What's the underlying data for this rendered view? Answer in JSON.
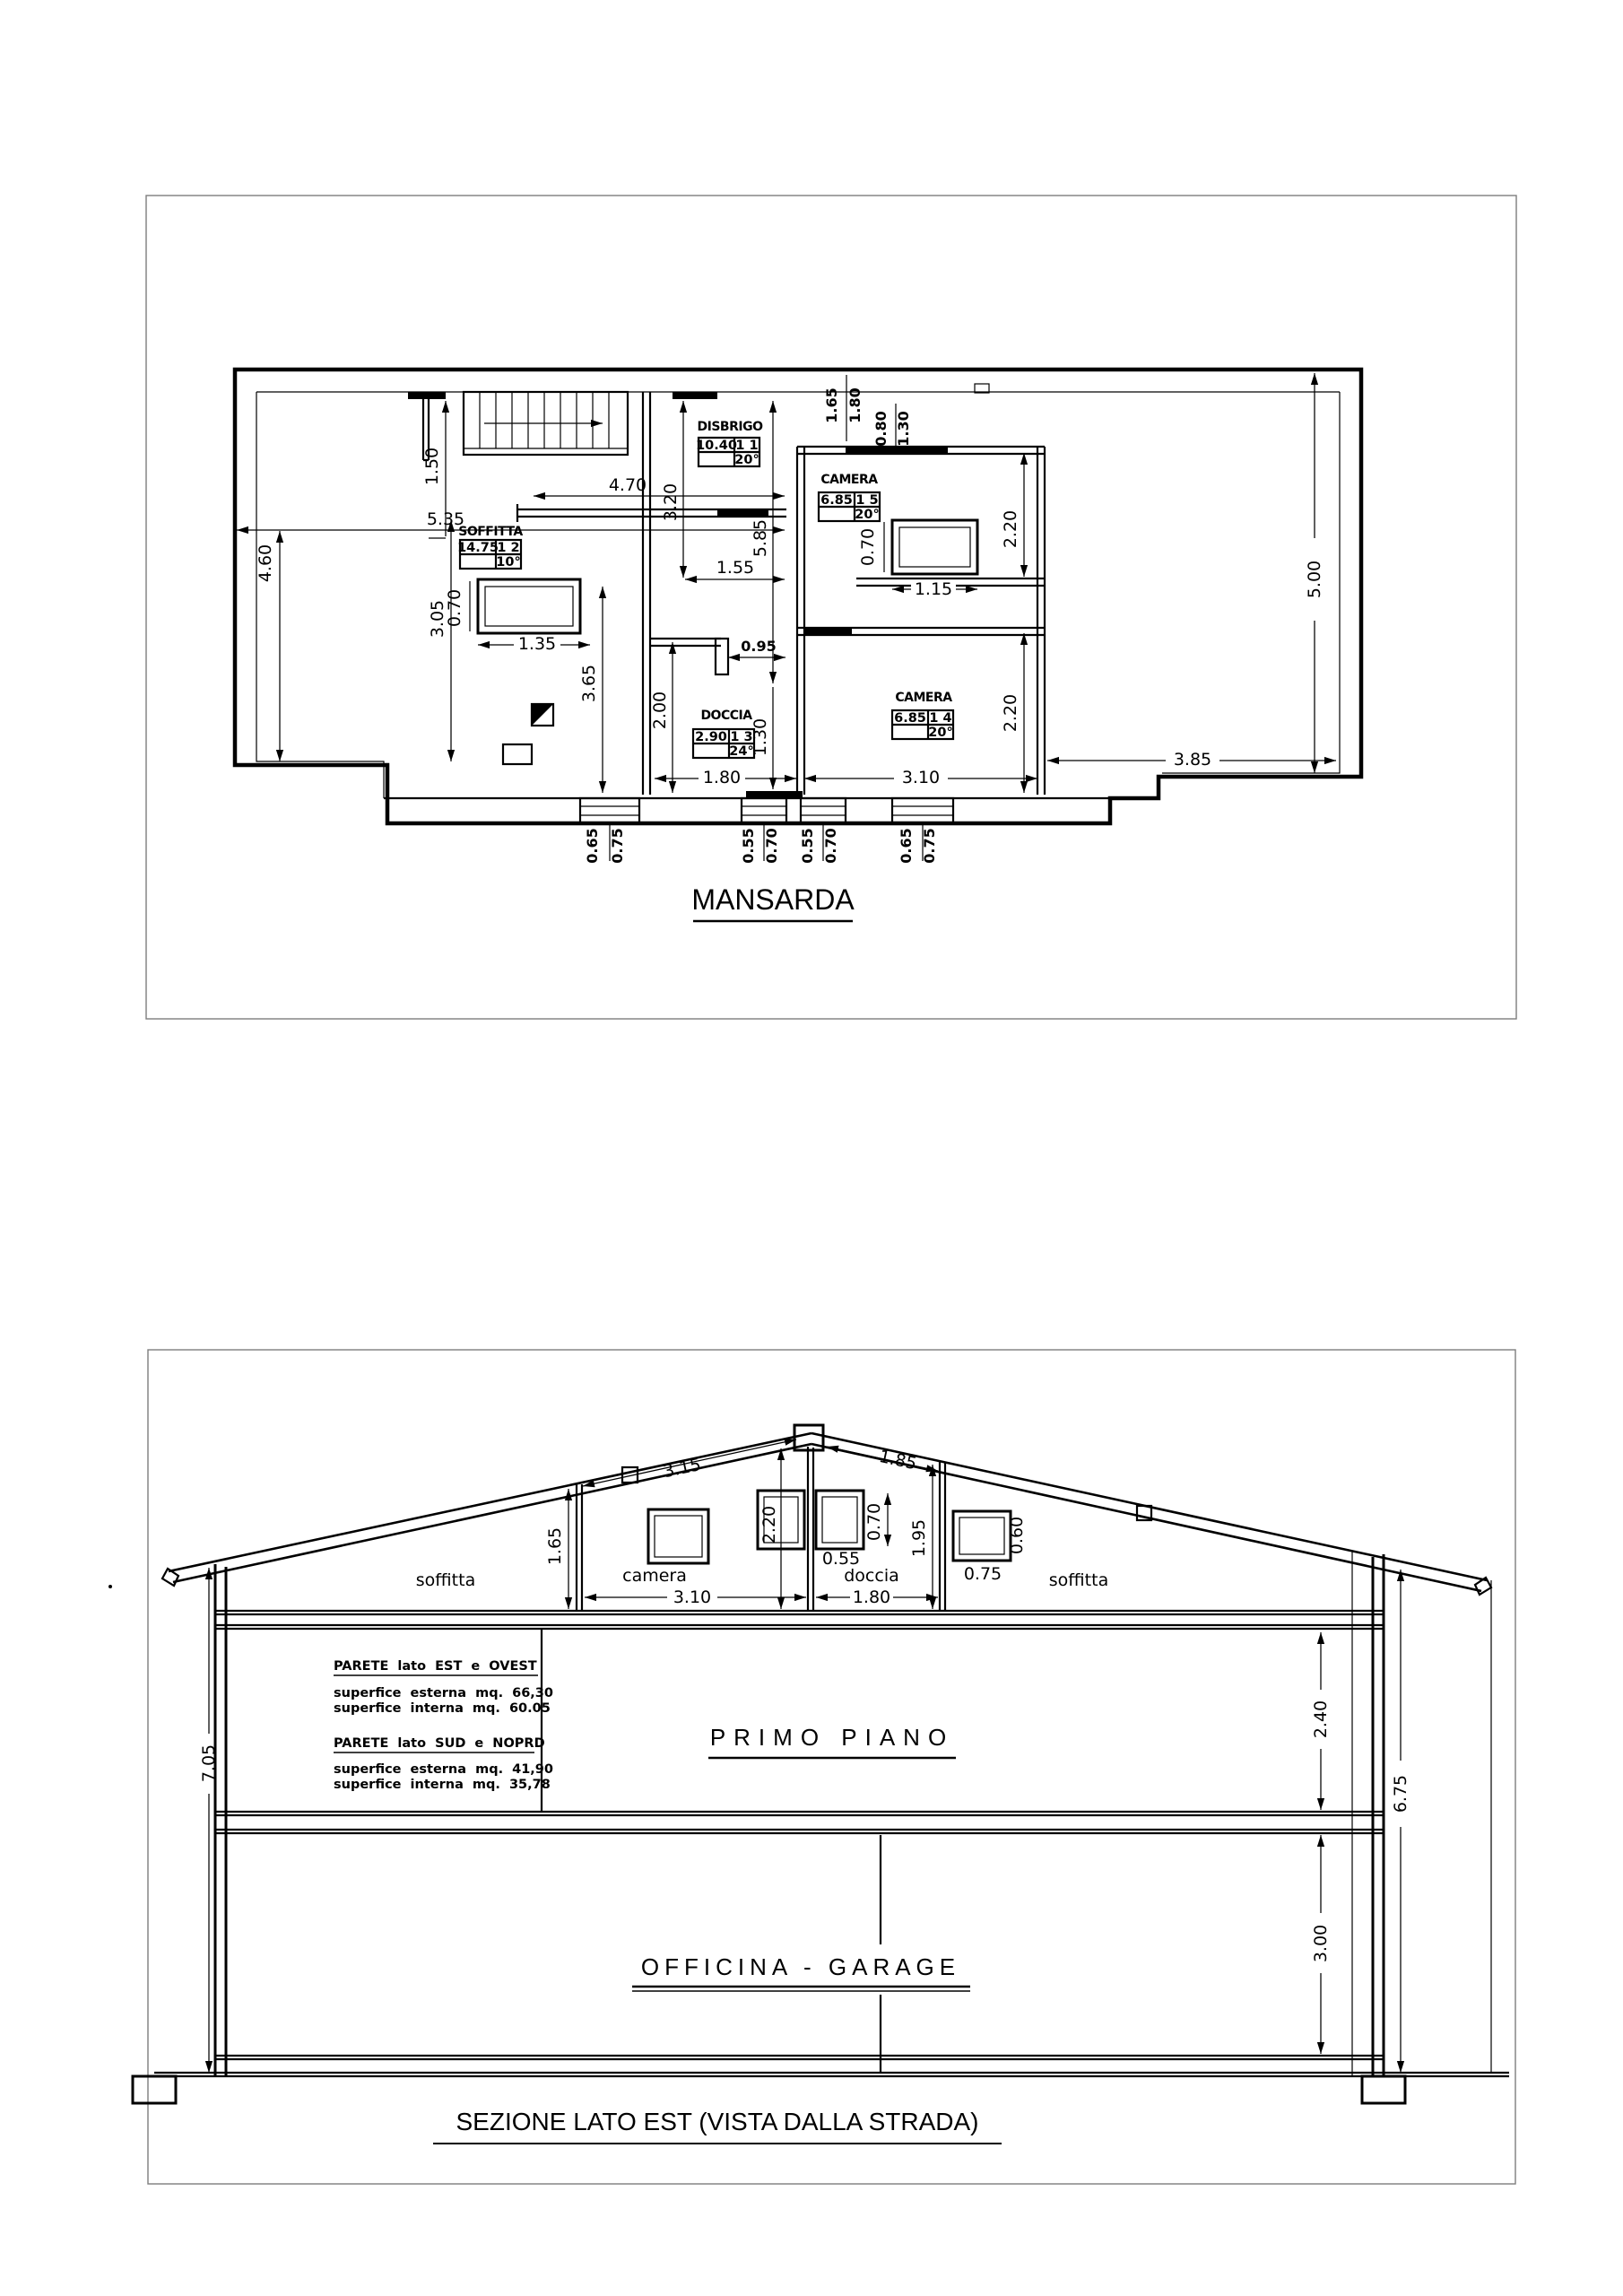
{
  "page": {
    "plan": {
      "title": "MANSARDA",
      "rooms": {
        "soffitta": {
          "name": "SOFFITTA",
          "mq": "14.75",
          "n": "1 2",
          "deg": "10°"
        },
        "disbrigo": {
          "name": "DISBRIGO",
          "mq": "10.40",
          "n": "1 1",
          "deg": "20°"
        },
        "camera5": {
          "name": "CAMERA",
          "mq": "6.85",
          "n": "1 5",
          "deg": "20°"
        },
        "doccia": {
          "name": "DOCCIA",
          "mq": "2.90",
          "n": "1 3",
          "deg": "24°"
        },
        "camera4": {
          "name": "CAMERA",
          "mq": "6.85",
          "n": "1 4",
          "deg": "20°"
        }
      },
      "dims": {
        "d055": "0.55",
        "d065": "0.65",
        "d070": "0.70",
        "d075": "0.75",
        "d080": "0.80",
        "d095": "0.95",
        "d115": "1.15",
        "d130": "1.30",
        "d135": "1.35",
        "d150": "1.50",
        "d155": "1.55",
        "d165": "1.65",
        "d180": "1.80",
        "d200": "2.00",
        "d220": "2.20",
        "d305": "3.05",
        "d310": "3.10",
        "d320": "3.20",
        "d365": "3.65",
        "d385": "3.85",
        "d460": "4.60",
        "d470": "4.70",
        "d500": "5.00",
        "d535": "5.35",
        "d585": "5.85"
      }
    },
    "section": {
      "title": "SEZIONE LATO EST (VISTA DALLA STRADA)",
      "floor1_label": "PRIMO PIANO",
      "garage_label": "OFFICINA - GARAGE",
      "attic": {
        "soffitta_left": "soffitta",
        "camera": "camera",
        "doccia": "doccia",
        "soffitta_right": "soffitta"
      },
      "notes": {
        "p1_title": "PARETE lato EST e OVEST",
        "p1_l1": "superfice esterna mq. 66,30",
        "p1_l2": "superfice interna mq. 60.05",
        "p2_title": "PARETE lato SUD e NOPRD",
        "p2_l1": "superfice esterna mq. 41,90",
        "p2_l2": "superfice interna mq. 35,78"
      },
      "dims": {
        "d055": "0.55",
        "d060": "0.60",
        "d070": "0.70",
        "d075": "0.75",
        "d165": "1.65",
        "d180": "1.80",
        "d185": "1.85",
        "d195": "1.95",
        "d220": "2.20",
        "d240": "2.40",
        "d300": "3.00",
        "d310": "3.10",
        "d315": "3.15",
        "d675": "6.75",
        "d705": "7.05"
      }
    }
  }
}
